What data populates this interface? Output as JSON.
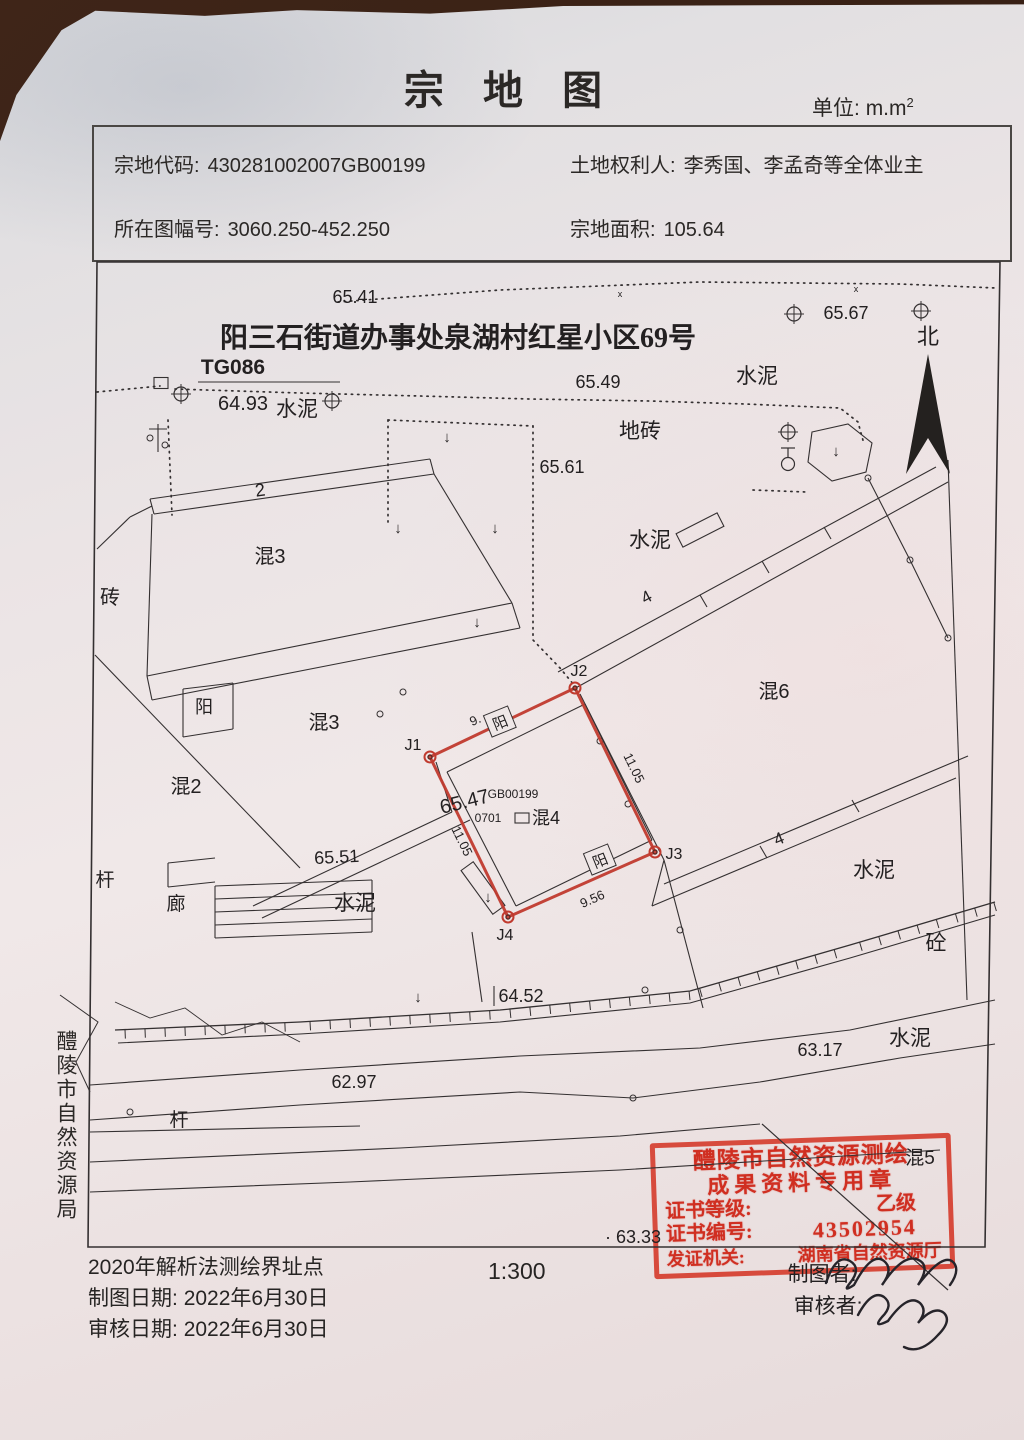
{
  "header": {
    "title": "宗 地 图",
    "unit_label": "单位:",
    "unit_value": "m.m",
    "unit_sup": "2"
  },
  "info": {
    "parcel_code_label": "宗地代码:",
    "parcel_code": "430281002007GB00199",
    "owner_label": "土地权利人:",
    "owner": "李秀国、李孟奇等全体业主",
    "sheet_label": "所在图幅号:",
    "sheet": "3060.250-452.250",
    "area_label": "宗地面积:",
    "area": "105.64"
  },
  "side_label": "醴陵市自然资源局",
  "footer": {
    "method": "2020年解析法测绘界址点",
    "draw_date_label": "制图日期:",
    "draw_date": "2022年6月30日",
    "review_date_label": "审核日期:",
    "review_date": "2022年6月30日",
    "scale": "1:300"
  },
  "stamp": {
    "line1": "醴陵市自然资源测绘",
    "line2": "成果资料专用章",
    "grade_label": "证书等级:",
    "grade": "乙级",
    "no_label": "证书编号:",
    "no": "43502954",
    "issuer_label": "发证机关:",
    "issuer": "湖南省自然资源厅",
    "overlay": [
      {
        "t": "制图者:",
        "x": 822,
        "y": 1281,
        "s": 21
      },
      {
        "t": "审核者:",
        "x": 828,
        "y": 1313,
        "s": 21
      }
    ],
    "signatures": [
      "M826,1283 q10,-30 24,-22 q12,7 0,22 q-8,10 4,2 q18,-34 30,-24 q10,8 -2,24 q20,-30 34,-26 q16,5 2,26 q26,-34 36,-22 q6,8 -4,22",
      "M858,1315 q14,-26 26,-18 q10,8 -2,20 q-10,12 6,4 q20,-28 32,-18 q8,8 -2,20 q16,-18 26,-10 q8,8 -6,22 q-18,20 -34,12"
    ]
  },
  "map_graphics": {
    "frame": "97,262 1000,262 985,1247 88,1247",
    "solid": [
      [
        97,
        549,
        130,
        517
      ],
      [
        130,
        517,
        152,
        506
      ],
      [
        150,
        499,
        430,
        459
      ],
      [
        154,
        514,
        434,
        474
      ],
      [
        150,
        499,
        154,
        514
      ],
      [
        430,
        459,
        434,
        474
      ],
      [
        152,
        514,
        147,
        676
      ],
      [
        147,
        676,
        512,
        603
      ],
      [
        434,
        474,
        512,
        603
      ],
      [
        147,
        676,
        152,
        700
      ],
      [
        512,
        603,
        520,
        628
      ],
      [
        152,
        700,
        520,
        628
      ],
      [
        95,
        655,
        300,
        868
      ],
      [
        253,
        906,
        452,
        812
      ],
      [
        262,
        918,
        470,
        820
      ],
      [
        452,
        812,
        436,
        762
      ],
      [
        183,
        689,
        183,
        737
      ],
      [
        183,
        737,
        233,
        729
      ],
      [
        183,
        689,
        233,
        683
      ],
      [
        233,
        683,
        233,
        729
      ],
      [
        198,
        382,
        340,
        382
      ],
      [
        215,
        886,
        372,
        880
      ],
      [
        215,
        899,
        372,
        893
      ],
      [
        215,
        912,
        372,
        906
      ],
      [
        215,
        925,
        372,
        919
      ],
      [
        215,
        938,
        372,
        932
      ],
      [
        215,
        886,
        215,
        938
      ],
      [
        372,
        880,
        372,
        932
      ],
      [
        168,
        863,
        215,
        858
      ],
      [
        168,
        863,
        168,
        887
      ],
      [
        168,
        887,
        215,
        882
      ],
      [
        558,
        672,
        936,
        467
      ],
      [
        572,
        690,
        948,
        482
      ],
      [
        700,
        595,
        707,
        607
      ],
      [
        762,
        561,
        769,
        573
      ],
      [
        824,
        527,
        831,
        539
      ],
      [
        948,
        460,
        967,
        1000
      ],
      [
        868,
        478,
        910,
        560
      ],
      [
        910,
        560,
        948,
        638
      ],
      [
        580,
        694,
        664,
        860
      ],
      [
        664,
        860,
        703,
        1008
      ],
      [
        664,
        884,
        968,
        756
      ],
      [
        652,
        906,
        956,
        778
      ],
      [
        664,
        860,
        652,
        906
      ],
      [
        760,
        846,
        767,
        858
      ],
      [
        852,
        800,
        859,
        812
      ],
      [
        472,
        932,
        482,
        1002
      ],
      [
        494,
        986,
        494,
        1006
      ],
      [
        90,
        1132,
        360,
        1126
      ],
      [
        447,
        772,
        585,
        704
      ],
      [
        585,
        704,
        652,
        840
      ],
      [
        652,
        840,
        516,
        906
      ],
      [
        516,
        906,
        447,
        772
      ],
      [
        158,
        424,
        158,
        452
      ],
      [
        149,
        429,
        167,
        429
      ]
    ],
    "polylines": [
      {
        "pts": [
          [
            115,
            1030
          ],
          [
            300,
            1022
          ],
          [
            500,
            1010
          ],
          [
            690,
            991
          ],
          [
            850,
            945
          ],
          [
            995,
            902
          ]
        ],
        "w": 1.3
      },
      {
        "pts": [
          [
            118,
            1043
          ],
          [
            300,
            1034
          ],
          [
            500,
            1022
          ],
          [
            690,
            1003
          ],
          [
            850,
            958
          ],
          [
            995,
            915
          ]
        ],
        "w": 1.1
      },
      {
        "pts": [
          [
            90,
            1085
          ],
          [
            300,
            1070
          ],
          [
            520,
            1056
          ],
          [
            700,
            1048
          ],
          [
            850,
            1030
          ],
          [
            995,
            1000
          ]
        ],
        "w": 1.1
      },
      {
        "pts": [
          [
            90,
            1120
          ],
          [
            300,
            1105
          ],
          [
            520,
            1092
          ],
          [
            633,
            1098
          ],
          [
            760,
            1082
          ],
          [
            900,
            1058
          ],
          [
            995,
            1044
          ]
        ],
        "w": 1.1
      },
      {
        "pts": [
          [
            90,
            1162
          ],
          [
            400,
            1148
          ],
          [
            620,
            1136
          ],
          [
            760,
            1124
          ]
        ],
        "w": 1.1
      },
      {
        "pts": [
          [
            762,
            1124
          ],
          [
            948,
            1290
          ]
        ],
        "w": 1.2
      },
      {
        "pts": [
          [
            90,
            1192
          ],
          [
            350,
            1182
          ],
          [
            620,
            1170
          ],
          [
            940,
            1150
          ]
        ],
        "w": 1.1
      },
      {
        "pts": [
          [
            115,
            1002
          ],
          [
            150,
            1018
          ],
          [
            185,
            1008
          ],
          [
            222,
            1035
          ],
          [
            262,
            1022
          ],
          [
            300,
            1042
          ]
        ],
        "w": 0.9
      },
      {
        "pts": [
          [
            60,
            995
          ],
          [
            98,
            1022
          ],
          [
            76,
            1062
          ],
          [
            90,
            1092
          ]
        ],
        "w": 1.0
      }
    ],
    "dotted": [
      [
        [
          338,
          302
        ],
        [
          500,
          290
        ],
        [
          700,
          282
        ],
        [
          900,
          284
        ],
        [
          996,
          288
        ]
      ],
      [
        [
          97,
          392
        ],
        [
          160,
          386
        ]
      ],
      [
        [
          175,
          389
        ],
        [
          300,
          393
        ],
        [
          420,
          396
        ],
        [
          530,
          399
        ],
        [
          650,
          401
        ],
        [
          745,
          404
        ],
        [
          840,
          408
        ],
        [
          858,
          422
        ],
        [
          864,
          444
        ]
      ],
      [
        [
          388,
          420
        ],
        [
          388,
          522
        ]
      ],
      [
        [
          388,
          420
        ],
        [
          533,
          426
        ]
      ],
      [
        [
          533,
          426
        ],
        [
          533,
          640
        ],
        [
          560,
          668
        ],
        [
          574,
          685
        ]
      ],
      [
        [
          168,
          420
        ],
        [
          172,
          515
        ]
      ],
      [
        [
          753,
          490
        ],
        [
          806,
          492
        ]
      ]
    ],
    "hatch": {
      "a": [
        [
          115,
          1030
        ],
        [
          300,
          1022
        ],
        [
          500,
          1010
        ],
        [
          690,
          991
        ],
        [
          850,
          945
        ],
        [
          995,
          902
        ]
      ],
      "len": 9,
      "step": 20
    },
    "parcel": {
      "pts": [
        [
          430,
          757
        ],
        [
          575,
          688
        ],
        [
          655,
          852
        ],
        [
          508,
          917
        ]
      ]
    },
    "hexagon": "812,432 848,424 872,443 866,472 832,481 808,462",
    "north": "928,354 906,474 928,438 950,474",
    "rects": [
      {
        "cx": 700,
        "cy": 530,
        "w": 46,
        "h": 15,
        "r": -27
      },
      {
        "cx": 483,
        "cy": 888,
        "w": 15,
        "h": 54,
        "r": -36
      },
      {
        "cx": 161,
        "cy": 383,
        "w": 14,
        "h": 11,
        "r": 0
      },
      {
        "cx": 522,
        "cy": 818,
        "w": 14,
        "h": 10,
        "r": 0
      }
    ],
    "yang_boxes": [
      {
        "cx": 500,
        "cy": 722,
        "r": -22,
        "t": "阳"
      },
      {
        "cx": 600,
        "cy": 860,
        "r": -22,
        "t": "阳"
      }
    ],
    "crosses": [
      [
        794,
        314
      ],
      [
        921,
        311
      ],
      [
        181,
        394
      ],
      [
        332,
        401
      ],
      [
        788,
        432
      ]
    ],
    "lamp": [
      788,
      464
    ],
    "circles": [
      [
        600,
        741
      ],
      [
        628,
        804
      ],
      [
        680,
        930
      ],
      [
        868,
        478
      ],
      [
        910,
        560
      ],
      [
        948,
        638
      ],
      [
        403,
        692
      ],
      [
        380,
        714
      ],
      [
        130,
        1112
      ],
      [
        645,
        990
      ],
      [
        633,
        1098
      ],
      [
        150,
        438
      ],
      [
        165,
        445
      ]
    ],
    "arrows": [
      [
        398,
        533
      ],
      [
        495,
        533
      ],
      [
        477,
        627
      ],
      [
        418,
        1002
      ],
      [
        488,
        902
      ],
      [
        836,
        456
      ],
      [
        447,
        442
      ]
    ],
    "labels": [
      {
        "t": "65.41",
        "x": 355,
        "y": 303,
        "s": 18
      },
      {
        "t": "65.67",
        "x": 846,
        "y": 319,
        "s": 18
      },
      {
        "t": "北",
        "x": 928,
        "y": 344,
        "s": 22
      },
      {
        "t": "TG086",
        "x": 233,
        "y": 374,
        "s": 21,
        "b": 1
      },
      {
        "t": "64.93",
        "x": 243,
        "y": 410,
        "s": 20
      },
      {
        "t": "水泥",
        "x": 297,
        "y": 416,
        "s": 21
      },
      {
        "t": "65.49",
        "x": 598,
        "y": 388,
        "s": 18
      },
      {
        "t": "水泥",
        "x": 757,
        "y": 383,
        "s": 21
      },
      {
        "t": "地砖",
        "x": 640,
        "y": 438,
        "s": 21
      },
      {
        "t": "65.61",
        "x": 562,
        "y": 473,
        "s": 18
      },
      {
        "t": "水泥",
        "x": 650,
        "y": 547,
        "s": 21
      },
      {
        "t": "砖",
        "x": 110,
        "y": 604,
        "s": 20
      },
      {
        "t": "混3",
        "x": 270,
        "y": 563,
        "s": 20
      },
      {
        "t": "2",
        "x": 261,
        "y": 496,
        "s": 18,
        "r": -8
      },
      {
        "t": "4",
        "x": 649,
        "y": 602,
        "s": 17,
        "r": -28
      },
      {
        "t": "混6",
        "x": 774,
        "y": 698,
        "s": 20
      },
      {
        "t": "混3",
        "x": 324,
        "y": 729,
        "s": 20
      },
      {
        "t": "阳",
        "x": 204,
        "y": 713,
        "s": 18
      },
      {
        "t": "混2",
        "x": 186,
        "y": 793,
        "s": 20
      },
      {
        "t": "杆",
        "x": 105,
        "y": 886,
        "s": 19
      },
      {
        "t": "廊",
        "x": 176,
        "y": 910,
        "s": 19
      },
      {
        "t": "65.51",
        "x": 337,
        "y": 863,
        "s": 18,
        "r": -3
      },
      {
        "t": "水泥",
        "x": 355,
        "y": 910,
        "s": 21
      },
      {
        "t": "4",
        "x": 781,
        "y": 844,
        "s": 17,
        "r": -22
      },
      {
        "t": "水泥",
        "x": 874,
        "y": 877,
        "s": 21
      },
      {
        "t": "砼",
        "x": 936,
        "y": 950,
        "s": 21
      },
      {
        "t": "64.52",
        "x": 521,
        "y": 1002,
        "s": 18
      },
      {
        "t": "水泥",
        "x": 910,
        "y": 1045,
        "s": 21
      },
      {
        "t": "63.17",
        "x": 820,
        "y": 1056,
        "s": 18
      },
      {
        "t": "62.97",
        "x": 354,
        "y": 1088,
        "s": 18
      },
      {
        "t": "杆",
        "x": 179,
        "y": 1126,
        "s": 19
      },
      {
        "t": "· 63.33",
        "x": 633,
        "y": 1243,
        "s": 18
      },
      {
        "t": "混5",
        "x": 920,
        "y": 1164,
        "s": 19
      },
      {
        "t": "J1",
        "x": 413,
        "y": 750,
        "s": 16
      },
      {
        "t": "J2",
        "x": 579,
        "y": 676,
        "s": 16
      },
      {
        "t": "J3",
        "x": 674,
        "y": 859,
        "s": 16
      },
      {
        "t": "J4",
        "x": 505,
        "y": 940,
        "s": 16
      },
      {
        "t": "11.05",
        "x": 630,
        "y": 770,
        "s": 13,
        "r": 64
      },
      {
        "t": "11.05",
        "x": 458,
        "y": 843,
        "s": 13,
        "r": 64
      },
      {
        "t": "9.56",
        "x": 594,
        "y": 903,
        "s": 13,
        "r": -24
      },
      {
        "t": "9.",
        "x": 477,
        "y": 724,
        "s": 13,
        "r": -24
      },
      {
        "t": "GB00199",
        "x": 513,
        "y": 798,
        "s": 12
      },
      {
        "t": "0701",
        "x": 488,
        "y": 822,
        "s": 12
      },
      {
        "t": "混4",
        "x": 546,
        "y": 824,
        "s": 18
      },
      {
        "t": "65.47",
        "x": 466,
        "y": 808,
        "s": 20,
        "r": -14
      },
      {
        "t": "阳三石街道办事处泉湖村红星小区69号",
        "x": 458,
        "y": 347,
        "s": 28,
        "b": 1,
        "f": "serif"
      },
      {
        "t": "x",
        "x": 620,
        "y": 297,
        "s": 9
      },
      {
        "t": "x",
        "x": 856,
        "y": 292,
        "s": 9
      }
    ]
  }
}
